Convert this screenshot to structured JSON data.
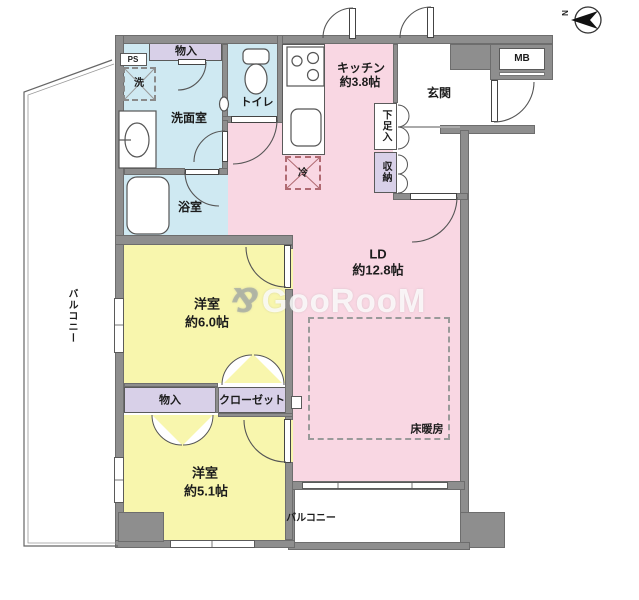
{
  "colors": {
    "wall": "#8e8e8e",
    "room_pink": "#f9d7e3",
    "room_yellow": "#f8f6ad",
    "room_blue": "#cfe9f2",
    "storage_purple": "#d8d0e8"
  },
  "compass": {
    "north_label": "N"
  },
  "watermark": {
    "logo": "⅋",
    "text": "GooRooM"
  },
  "rooms": {
    "kitchen": {
      "name": "キッチン",
      "size": "約3.8帖"
    },
    "living_dining": {
      "name": "LD",
      "size": "約12.8帖"
    },
    "bedroom1": {
      "name": "洋室",
      "size": "約6.0帖"
    },
    "bedroom2": {
      "name": "洋室",
      "size": "約5.1帖"
    },
    "entrance": {
      "name": "玄関"
    },
    "washroom": {
      "name": "洗面室"
    },
    "toilet": {
      "name": "トイレ"
    },
    "bathroom": {
      "name": "浴室"
    },
    "balcony_left": {
      "name": "バルコニー"
    },
    "balcony_bottom": {
      "name": "バルコニー"
    },
    "floor_heating": {
      "name": "床暖房"
    }
  },
  "storage": {
    "pipe_shaft": "PS",
    "meter_box": "MB",
    "upper_closet": "物入",
    "shoe_cabinet": "下足入",
    "hall_storage": "収納",
    "bedroom_storage": "物入",
    "closet": "クローゼット"
  },
  "appliances": {
    "washer": "洗",
    "fridge": "冷"
  }
}
